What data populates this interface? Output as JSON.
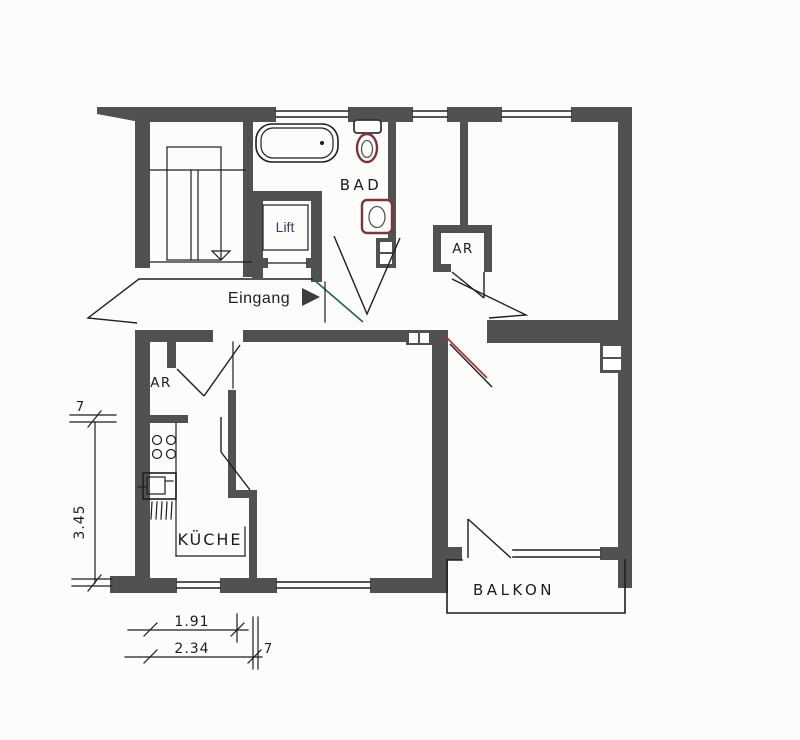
{
  "plan": {
    "type": "apartment-floor-plan",
    "rooms": {
      "bathroom": {
        "label": "BAD"
      },
      "lift": {
        "label": "Lift"
      },
      "entrance": {
        "label": "Eingang"
      },
      "storage_top": {
        "label": "AR"
      },
      "storage_bottom": {
        "label": "AR"
      },
      "kitchen": {
        "label": "KÜCHE"
      },
      "balcony": {
        "label": "BALKON"
      }
    },
    "dimensions": {
      "wall_thickness_left": "7",
      "kitchen_depth": "3.45",
      "kitchen_inner_width": "1.91",
      "kitchen_outer_width": "2.34",
      "wall_thickness_bottom": "7"
    }
  },
  "colors": {
    "wall": "#515151",
    "line": "#1e1e1e",
    "fixture": "#7c363b",
    "accent": "#a13a32",
    "teal": "#31605a",
    "text": "#1c1c1c",
    "lift_text": "#33415c",
    "background": "#fcfcfb"
  }
}
